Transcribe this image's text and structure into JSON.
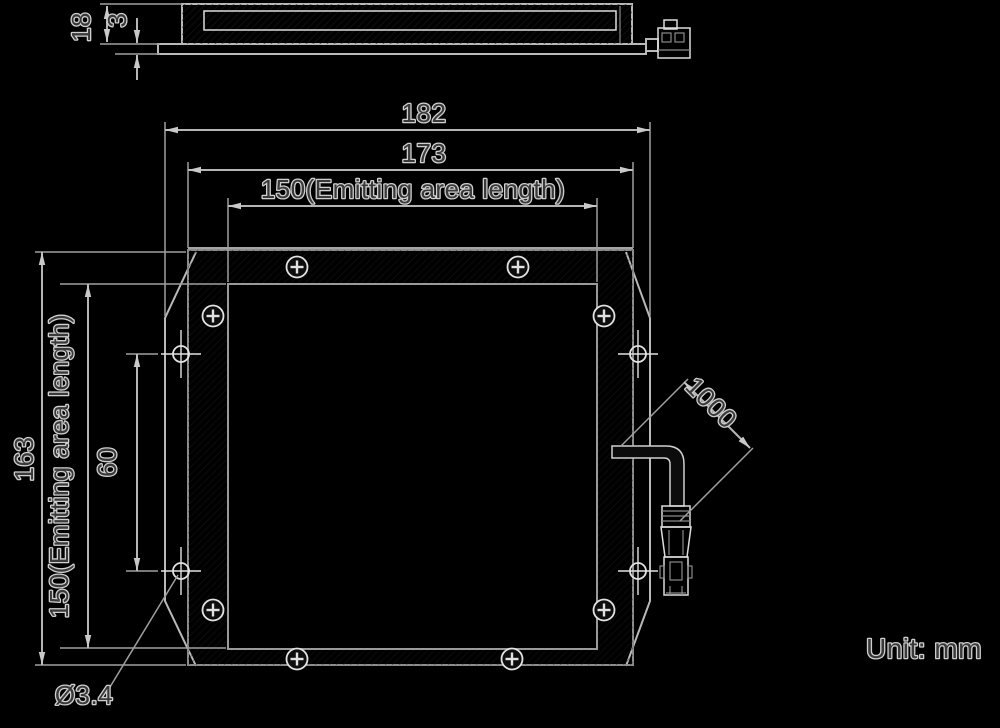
{
  "unit_note": "Unit: mm",
  "top_view": {
    "overall_thickness": "18",
    "plate_thickness": "3"
  },
  "front_view": {
    "overall_width": "182",
    "frame_width": "173",
    "emitting_area_width": "150(Emitting area length)",
    "overall_height": "163",
    "emitting_area_height": "150(Emitting area length)",
    "mount_hole_spacing": "60",
    "mount_hole_diameter": "Ø3.4",
    "cable_length": "1000"
  }
}
